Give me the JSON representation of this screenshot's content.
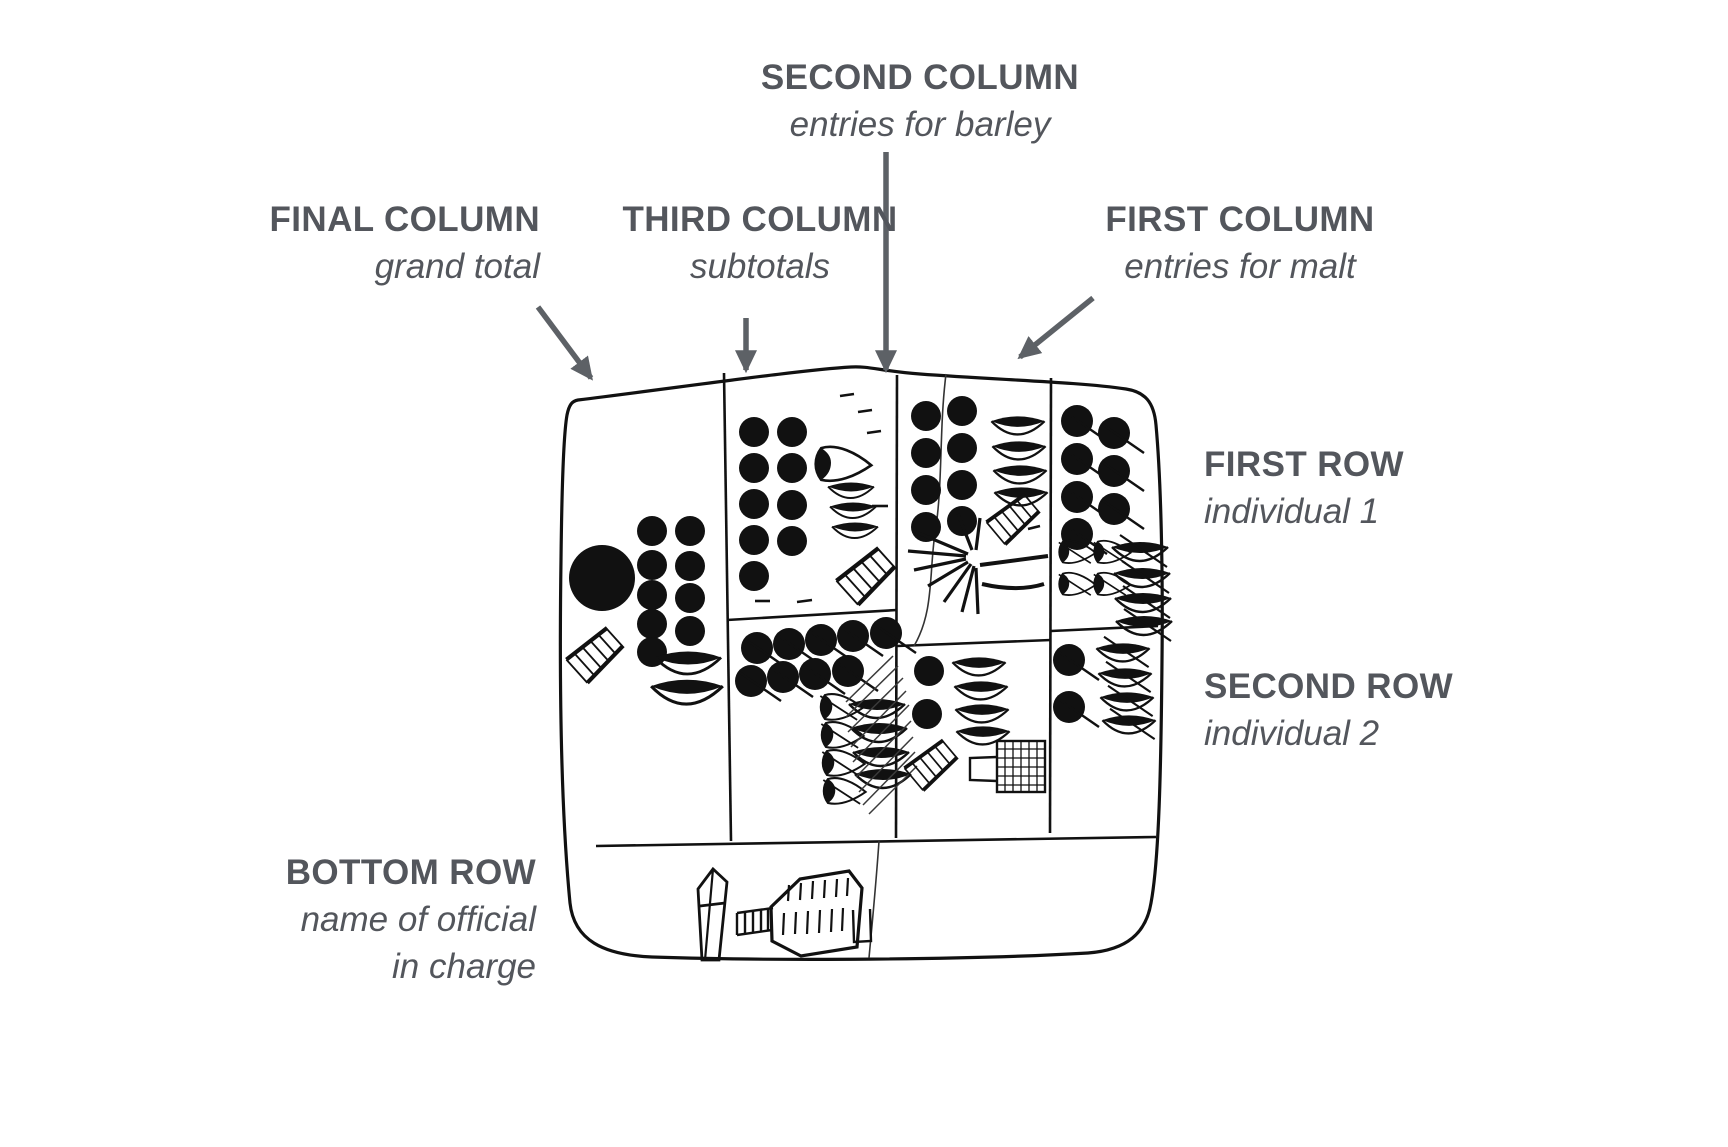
{
  "colors": {
    "background": "#ffffff",
    "text": "#53565c",
    "arrow": "#5d6166",
    "ink": "#111111"
  },
  "labels": {
    "second_column": {
      "title": "SECOND COLUMN",
      "subtitle": "entries for barley"
    },
    "final_column": {
      "title": "FINAL COLUMN",
      "subtitle": "grand total"
    },
    "third_column": {
      "title": "THIRD COLUMN",
      "subtitle": "subtotals"
    },
    "first_column": {
      "title": "FIRST COLUMN",
      "subtitle": "entries for malt"
    },
    "first_row": {
      "title": "FIRST ROW",
      "subtitle": "individual 1"
    },
    "second_row": {
      "title": "SECOND ROW",
      "subtitle": "individual 2"
    },
    "bottom_row": {
      "title": "BOTTOM ROW",
      "subtitle_line1": "name of official",
      "subtitle_line2": "in charge"
    }
  },
  "tablet": {
    "kind": "hand-drawn archaic accounting tablet with ruled cases",
    "glyph_summary": {
      "final_column": "1 large disc, 9 small discs, hatched band sign, 2 crescents",
      "third_column_upper": "9 small discs, 1 pointed crescent, 3 crescents, hatched band sign",
      "third_column_lower": "9 discs with strokes, 4 pointed crescents, 4 crescents under damage hatching",
      "second_column_upper": "8 small discs, 4 crescents, hatched band sign, star-burst sign, 2 long strokes",
      "second_column_lower": "2 discs, 4 crescents, hatched band sign, gridded net sign",
      "first_column_upper": "7 discs with strokes, 4 small pointed crescents, 4 crescents with strokes",
      "first_column_lower": "2 discs with strokes, 4 crescents with strokes",
      "bottom_row": "name signs of official: standard, ladder sign, hatched vessel"
    }
  }
}
